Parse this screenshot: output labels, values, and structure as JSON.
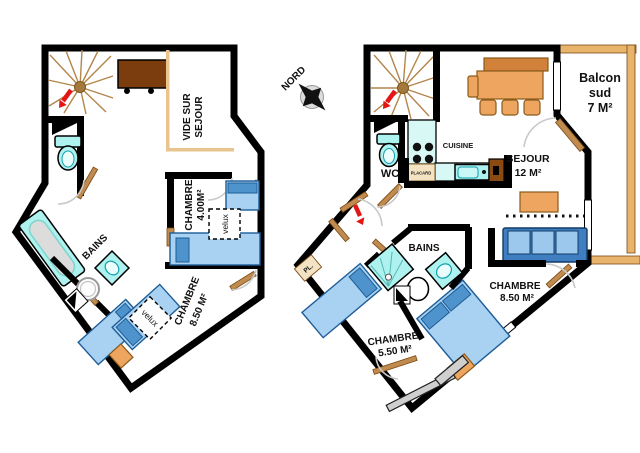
{
  "colors": {
    "wall": "#000000",
    "bed_blue": "#a9d2f2",
    "pillow_blue": "#4f93cc",
    "sofa_blue": "#3f7fc1",
    "fixture_cyan": "#aef2ef",
    "wood_door": "#c08b4f",
    "furniture_orange": "#eda55f",
    "desk_brown": "#7b3c0e",
    "railing_tan": "#e8b36a",
    "arrow_red": "#e51515",
    "arc_gray": "#c9c9c9"
  },
  "compass": {
    "label": "NORD"
  },
  "upper_plan": {
    "rooms": {
      "vide_sur_sejour": {
        "line1": "VIDE SUR",
        "line2": "SEJOUR"
      },
      "chambre_4": {
        "name": "CHAMBRE",
        "area": "4.00M²",
        "skylight": "velux"
      },
      "bains": {
        "name": "BAINS"
      },
      "chambre_8_5": {
        "name": "CHAMBRE",
        "area": "8.50 M²",
        "skylight": "velux"
      }
    }
  },
  "main_plan": {
    "rooms": {
      "balcon": {
        "line1": "Balcon",
        "line2": "sud",
        "line3": "7 M²"
      },
      "wc": {
        "name": "WC"
      },
      "cuisine": {
        "name": "CUISINE",
        "closet": "PLACARD"
      },
      "sejour": {
        "name": "SEJOUR",
        "area": "12 M²"
      },
      "bains": {
        "name": "BAINS"
      },
      "chambre_8_5": {
        "name": "CHAMBRE",
        "area": "8.50 M²"
      },
      "chambre_5_5": {
        "name": "CHAMBRE",
        "area": "5.50 M²"
      },
      "closet": {
        "name": "PL."
      }
    }
  }
}
